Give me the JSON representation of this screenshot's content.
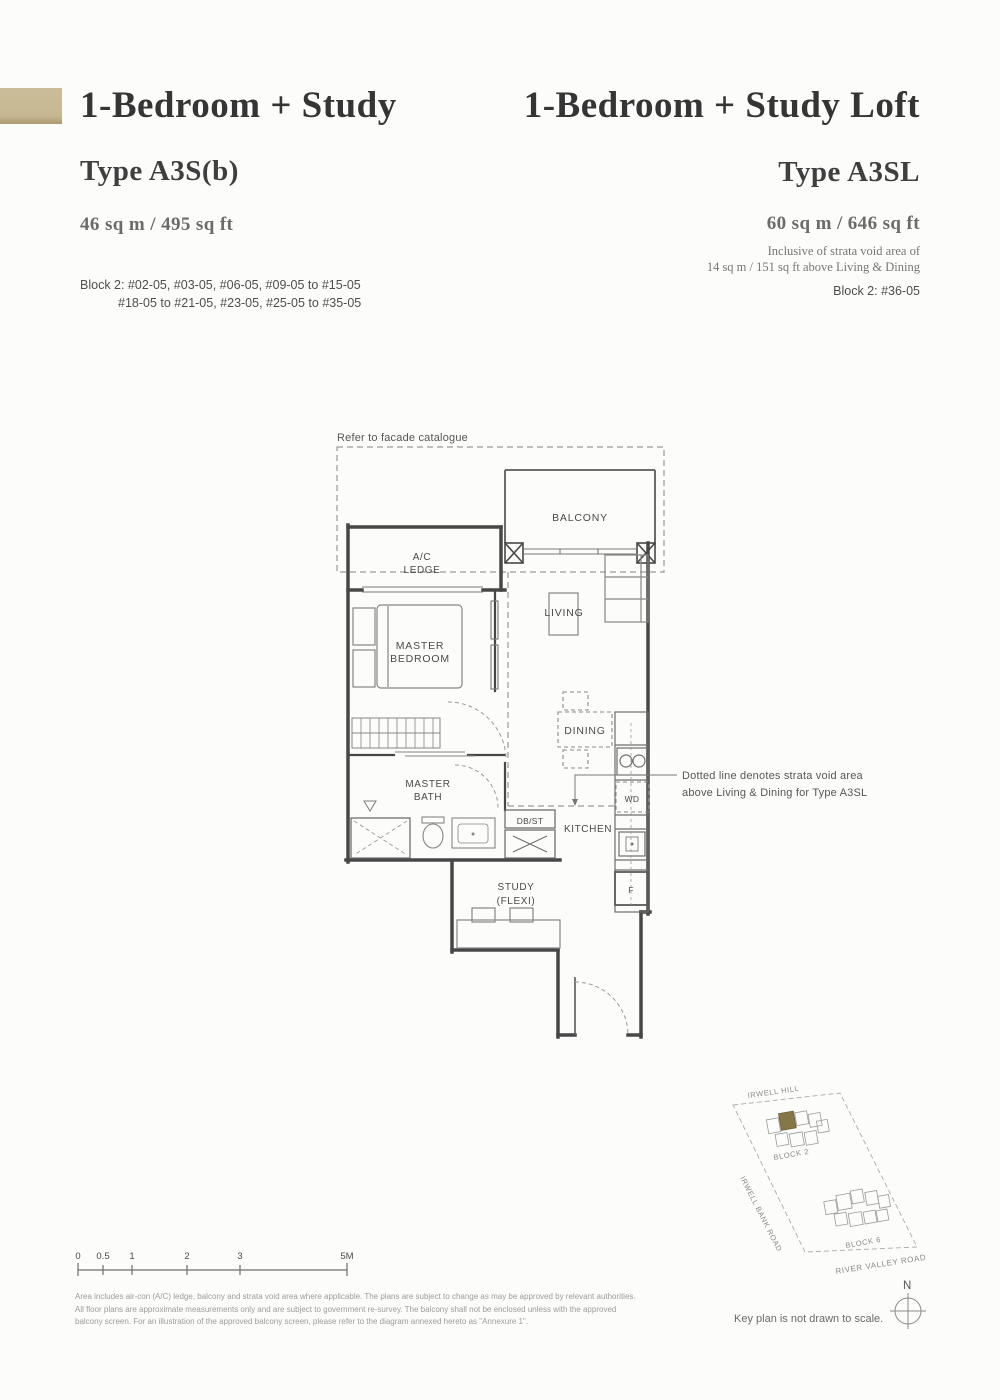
{
  "left_unit": {
    "title": "1-Bedroom + Study",
    "type": "Type A3S(b)",
    "area": "46 sq m / 495 sq ft",
    "blocks_line1": "Block 2: #02-05, #03-05, #06-05, #09-05 to #15-05",
    "blocks_line2": "#18-05 to #21-05, #23-05, #25-05 to #35-05"
  },
  "right_unit": {
    "title": "1-Bedroom + Study Loft",
    "type": "Type A3SL",
    "area": "60 sq m / 646 sq ft",
    "inclusive_line1": "Inclusive of strata void area of",
    "inclusive_line2": "14 sq m / 151 sq ft above Living & Dining",
    "blocks": "Block 2: #36-05"
  },
  "floorplan": {
    "facade_note": "Refer to facade catalogue",
    "rooms": {
      "balcony": "BALCONY",
      "ac_ledge_1": "A/C",
      "ac_ledge_2": "LEDGE",
      "living": "LIVING",
      "master_bedroom_1": "MASTER",
      "master_bedroom_2": "BEDROOM",
      "dining": "DINING",
      "master_bath_1": "MASTER",
      "master_bath_2": "BATH",
      "db_st": "DB/ST",
      "kitchen": "KITCHEN",
      "wd": "WD",
      "fridge": "F",
      "study_1": "STUDY",
      "study_2": "(FLEXI)"
    },
    "annotation_line1": "Dotted line denotes strata void area",
    "annotation_line2": "above Living & Dining for Type A3SL"
  },
  "key_plan": {
    "road_top": "IRWELL HILL",
    "road_left": "IRWELL BANK ROAD",
    "road_bottom": "RIVER VALLEY ROAD",
    "block2": "BLOCK 2",
    "block6": "BLOCK 6",
    "compass": "N",
    "note": "Key plan is not drawn to scale."
  },
  "scale_bar": {
    "labels": [
      "0",
      "0.5",
      "1",
      "2",
      "3",
      "5M"
    ]
  },
  "disclaimer": {
    "line1": "Area includes air-con (A/C) ledge, balcony and strata void area where applicable. The plans are subject to change as may be approved by relevant authorities.",
    "line2": "All floor plans are approximate measurements only and are subject to government re-survey. The balcony shall not be enclosed unless with the approved",
    "line3": "balcony screen. For an illustration of the approved balcony screen, please refer to the diagram annexed hereto as \"Annexure 1\"."
  },
  "colors": {
    "accent_tan": "#c9ba96",
    "highlight_unit": "#867748",
    "wall": "#474747"
  }
}
